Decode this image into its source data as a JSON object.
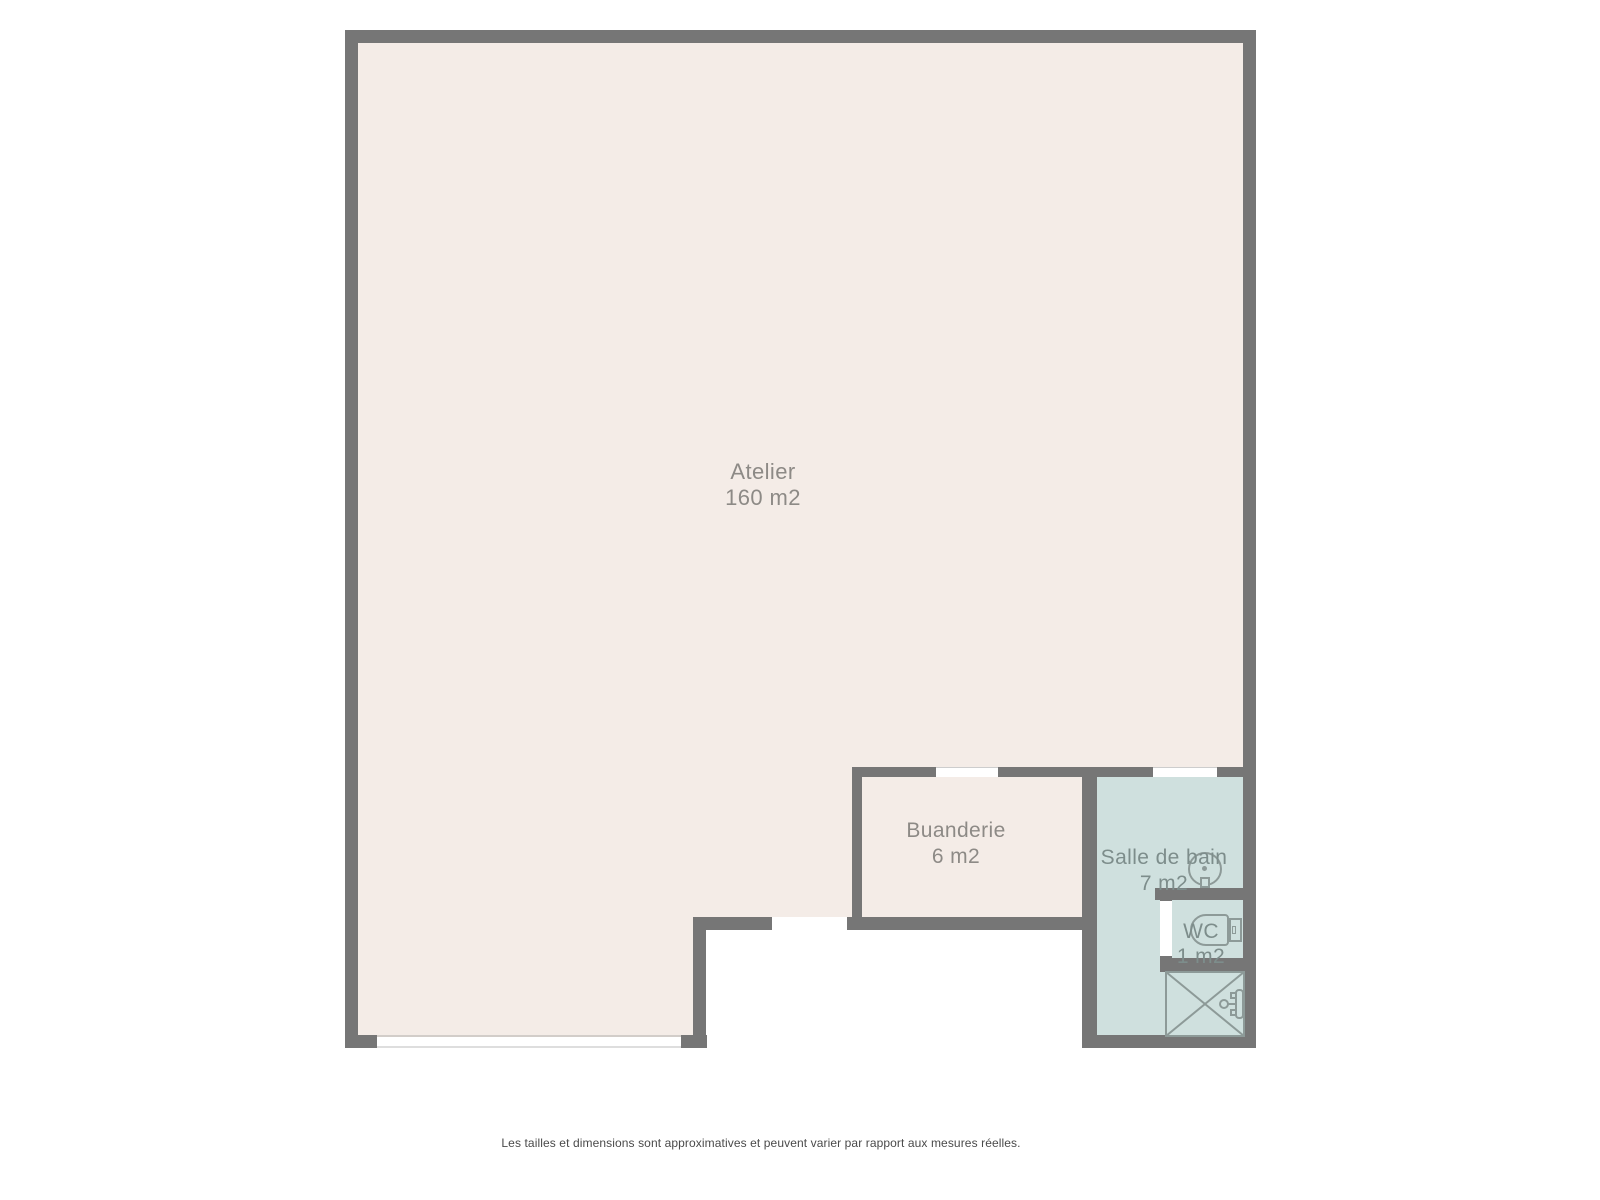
{
  "rooms": [
    {
      "name": "Atelier",
      "area": "160 m2"
    },
    {
      "name": "Buanderie",
      "area": "6 m2"
    },
    {
      "name": "Salle de bain",
      "area": "7 m2"
    },
    {
      "name": "WC",
      "area": "1 m2"
    }
  ],
  "fixtures": {
    "washbasin": "washbasin",
    "toilet": "toilet",
    "shower": "shower"
  },
  "openings": {
    "window_bottom": "window",
    "door_atelier_exterior": "door-opening",
    "door_buanderie": "door-opening",
    "door_salle_de_bain": "door-opening",
    "door_wc": "door-opening"
  },
  "colors": {
    "floor_dry": "#f4ece7",
    "floor_wet": "#cfe0de",
    "wall": "#767676",
    "fixture_outline": "#8d9a98",
    "label_dry": "#8d8a86",
    "label_wet": "#7d8d8b",
    "note_text": "#4a4a4a"
  },
  "footer": {
    "disclaimer": "Les tailles et dimensions sont approximatives et peuvent varier par rapport aux mesures réelles."
  }
}
